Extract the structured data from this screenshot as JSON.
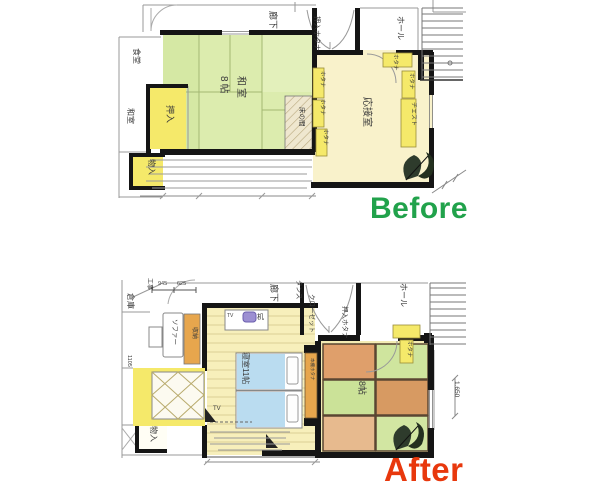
{
  "page": {
    "width": 600,
    "height": 500,
    "background": "#ffffff"
  },
  "palette": {
    "before_green": "#21a24b",
    "after_red": "#e8380d",
    "tatami_green": "#dcecae",
    "room_cream": "#f9f2cb",
    "cabinet_yellow": "#f5e96a",
    "accent_orange": "#e7a64d",
    "blanket_blue": "#badcf0",
    "wall_black": "#151515"
  },
  "before": {
    "caption": "Before",
    "caption_color": "#21a24b",
    "labels": {
      "dining": "食堂",
      "washitsu_side": "和室",
      "corridor": "廊下",
      "oshiire_hotana": "押入ホタナ",
      "hall": "ホール",
      "room_name": "和室",
      "room_size": "8帖",
      "oshiire": "押入",
      "tokonoma": "床の間",
      "reception": "応接室",
      "hotana": "ホタナ",
      "chest": "チェスト",
      "monoire": "物入"
    }
  },
  "after": {
    "caption": "After",
    "caption_color": "#e8380d",
    "labels": {
      "koji": "工事",
      "dim_945": "945",
      "dim_625": "625",
      "warehouse": "倉庫",
      "dim_1105": "1105",
      "corridor": "廊下",
      "tansu": "タンス",
      "closet": "クローゼット",
      "oshiire_hotana": "押入ホタナ",
      "hall": "ホール",
      "sofa": "ソファー",
      "shunou": "収納",
      "desk_tv": "TV",
      "desk": "机",
      "bedroom": "寝室11帖",
      "bookshelf": "本棚ホタナ",
      "tatami_size": "8帖",
      "hotana": "ホタナ",
      "monoire": "物入",
      "tv_floor": "TV",
      "dim_1650": "1.650"
    }
  }
}
